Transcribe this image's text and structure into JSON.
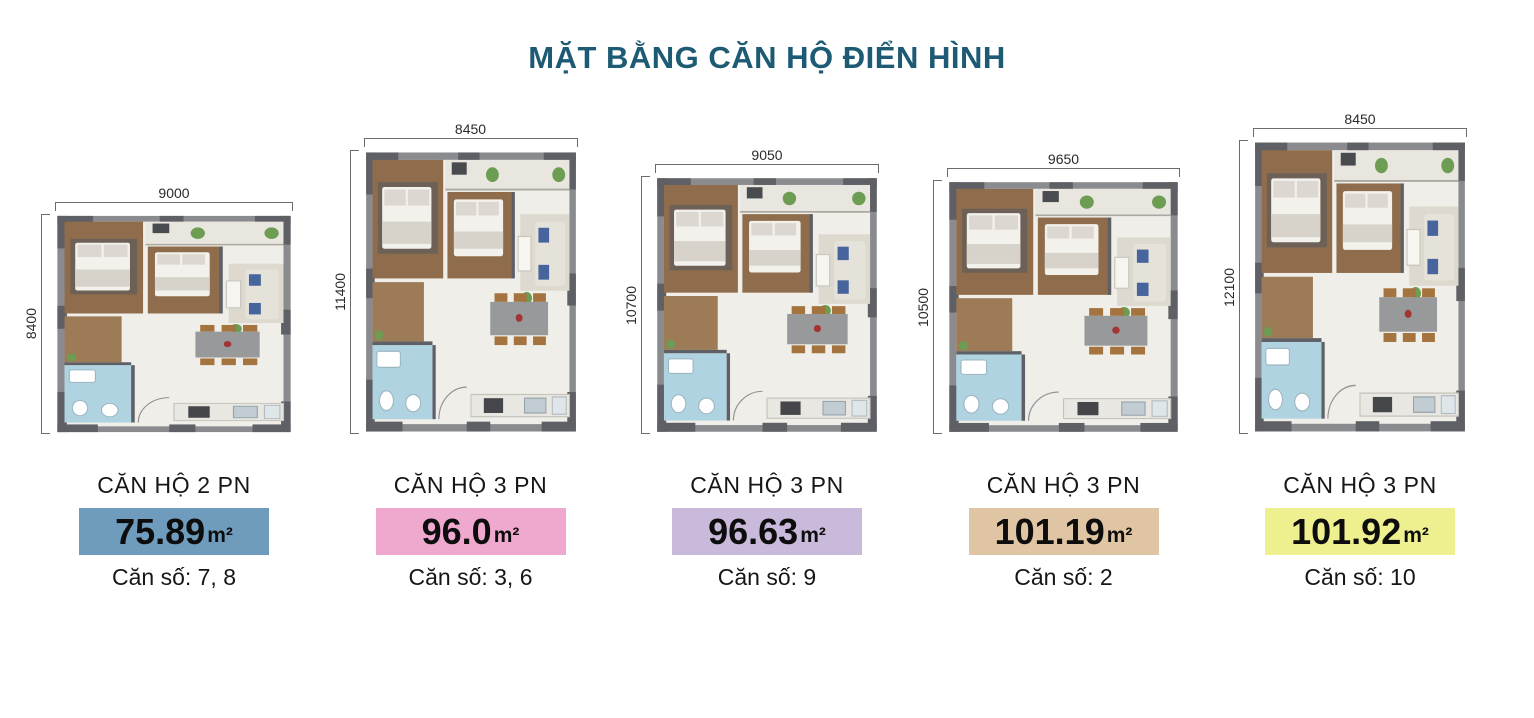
{
  "title": "MẶT BẰNG CĂN HỘ ĐIỂN HÌNH",
  "title_color": "#1d5a73",
  "apartments": [
    {
      "type_label": "CĂN HỘ 2 PN",
      "area": "75.89",
      "area_unit": "m²",
      "unit_numbers": "Căn số: 7, 8",
      "badge_color": "#6f9cbd",
      "dim_top": "9000",
      "dim_left": "8400"
    },
    {
      "type_label": "CĂN HỘ 3 PN",
      "area": "96.0",
      "area_unit": "m²",
      "unit_numbers": "Căn số: 3, 6",
      "badge_color": "#f0a9ce",
      "dim_top": "8450",
      "dim_left": "11400"
    },
    {
      "type_label": "CĂN HỘ 3 PN",
      "area": "96.63",
      "area_unit": "m²",
      "unit_numbers": "Căn số: 9",
      "badge_color": "#c9badb",
      "dim_top": "9050",
      "dim_left": "10700"
    },
    {
      "type_label": "CĂN HỘ 3 PN",
      "area": "101.19",
      "area_unit": "m²",
      "unit_numbers": "Căn số: 2",
      "badge_color": "#dfc5a3",
      "dim_top": "9650",
      "dim_left": "10500"
    },
    {
      "type_label": "CĂN HỘ 3 PN",
      "area": "101.92",
      "area_unit": "m²",
      "unit_numbers": "Căn số: 10",
      "badge_color": "#eef08f",
      "dim_top": "8450",
      "dim_left": "12100"
    }
  ]
}
